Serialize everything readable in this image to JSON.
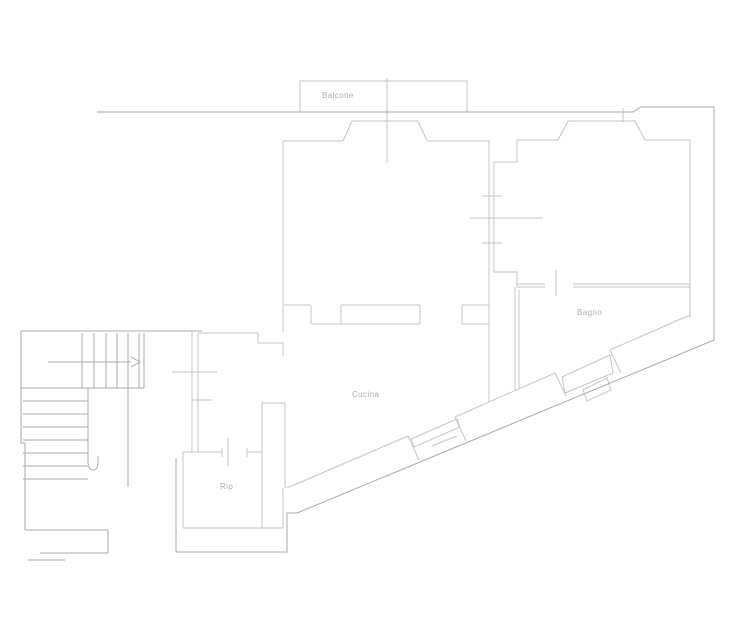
{
  "floor_plan": {
    "labels": {
      "balcony": "Balcone",
      "kitchen": "Cucina",
      "bathroom": "Bagno",
      "storage": "Rip"
    },
    "colors": {
      "background": "#ffffff",
      "wall_line": "#c6c6c6",
      "dark_line": "#ababab",
      "label_text": "#b0b0b0"
    }
  }
}
